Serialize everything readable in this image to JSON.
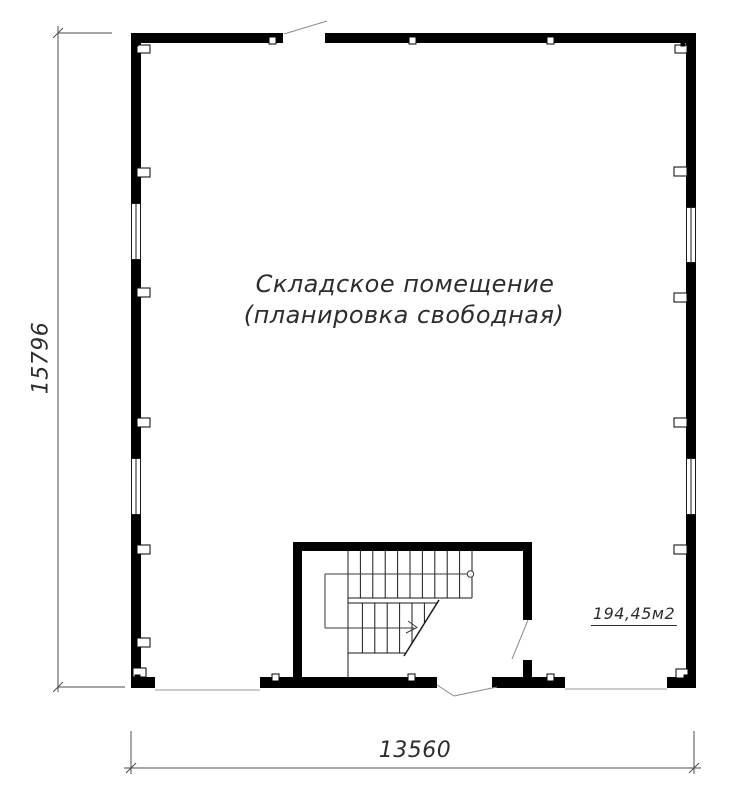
{
  "labels": {
    "room_name": "Складское помещение",
    "room_note": "(планировка свободная)",
    "area": "194,45м2",
    "height_dimension": "15796",
    "width_dimension": "13560"
  },
  "colors": {
    "background": "#ffffff",
    "walls": "#000000",
    "stair_lines": "#1a1a1a",
    "dimension_lines": "#4d4d4d",
    "door_lines": "#8a8a8a",
    "text": "#2d2d2d"
  }
}
